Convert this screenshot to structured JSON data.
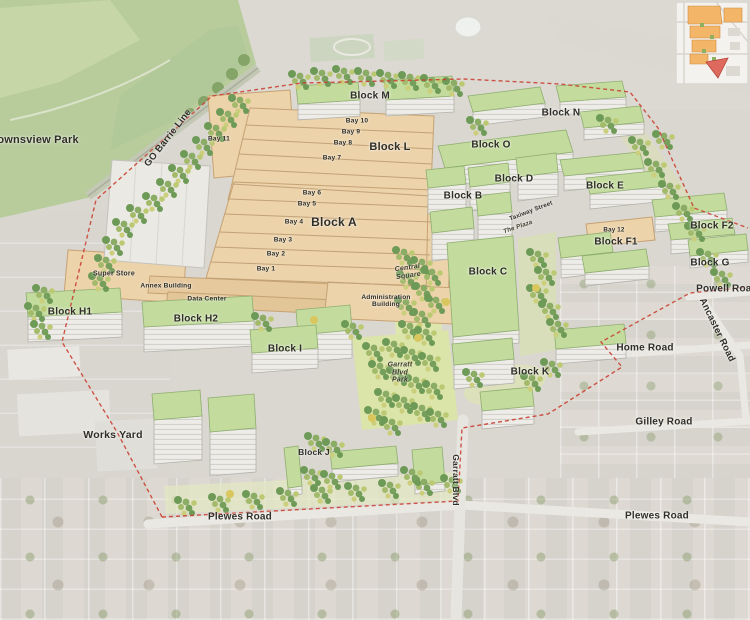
{
  "areas": {
    "downsview_park": "Downsview Park",
    "works_yard": "Works Yard",
    "garratt_blvd_park": "Garratt Blvd Park",
    "central_square": "Central Square",
    "the_plaza": "The Plaza"
  },
  "transit": {
    "go_barrie_line": "GO Barrie Line"
  },
  "roads": {
    "plewes_road": "Plewes Road",
    "powell_road": "Powell Road",
    "ancaster_road": "Ancaster Road",
    "home_road": "Home Road",
    "gilley_road": "Gilley Road",
    "garratt_blvd": "Garratt Blvd",
    "taxiway_street": "Taxiway Street"
  },
  "blocks": {
    "a": "Block A",
    "b": "Block B",
    "c": "Block C",
    "d": "Block D",
    "e": "Block E",
    "f1": "Block F1",
    "f2": "Block F2",
    "g": "Block G",
    "h1": "Block H1",
    "h2": "Block H2",
    "i": "Block I",
    "j": "Block J",
    "k": "Block K",
    "l": "Block L",
    "m": "Block M",
    "n": "Block N",
    "o": "Block O"
  },
  "bays": {
    "bay1": "Bay 1",
    "bay2": "Bay 2",
    "bay3": "Bay 3",
    "bay4": "Bay 4",
    "bay5": "Bay 5",
    "bay6": "Bay 6",
    "bay7": "Bay 7",
    "bay8": "Bay 8",
    "bay9": "Bay 9",
    "bay10": "Bay 10",
    "bay11": "Bay 11",
    "bay12": "Bay 12"
  },
  "buildings": {
    "super_store": "Super Store",
    "annex_building": "Annex Building",
    "data_center": "Data Center",
    "administration_building": "Administration Building"
  },
  "colors": {
    "warehouse_tan": "#ecd3aa",
    "green_roof": "#c3db9d",
    "park_green": "#b7cb9b",
    "boundary_red": "#c94334",
    "inset_district_orange": "#f3b668",
    "inset_highlight_red": "#dd6a5c"
  }
}
